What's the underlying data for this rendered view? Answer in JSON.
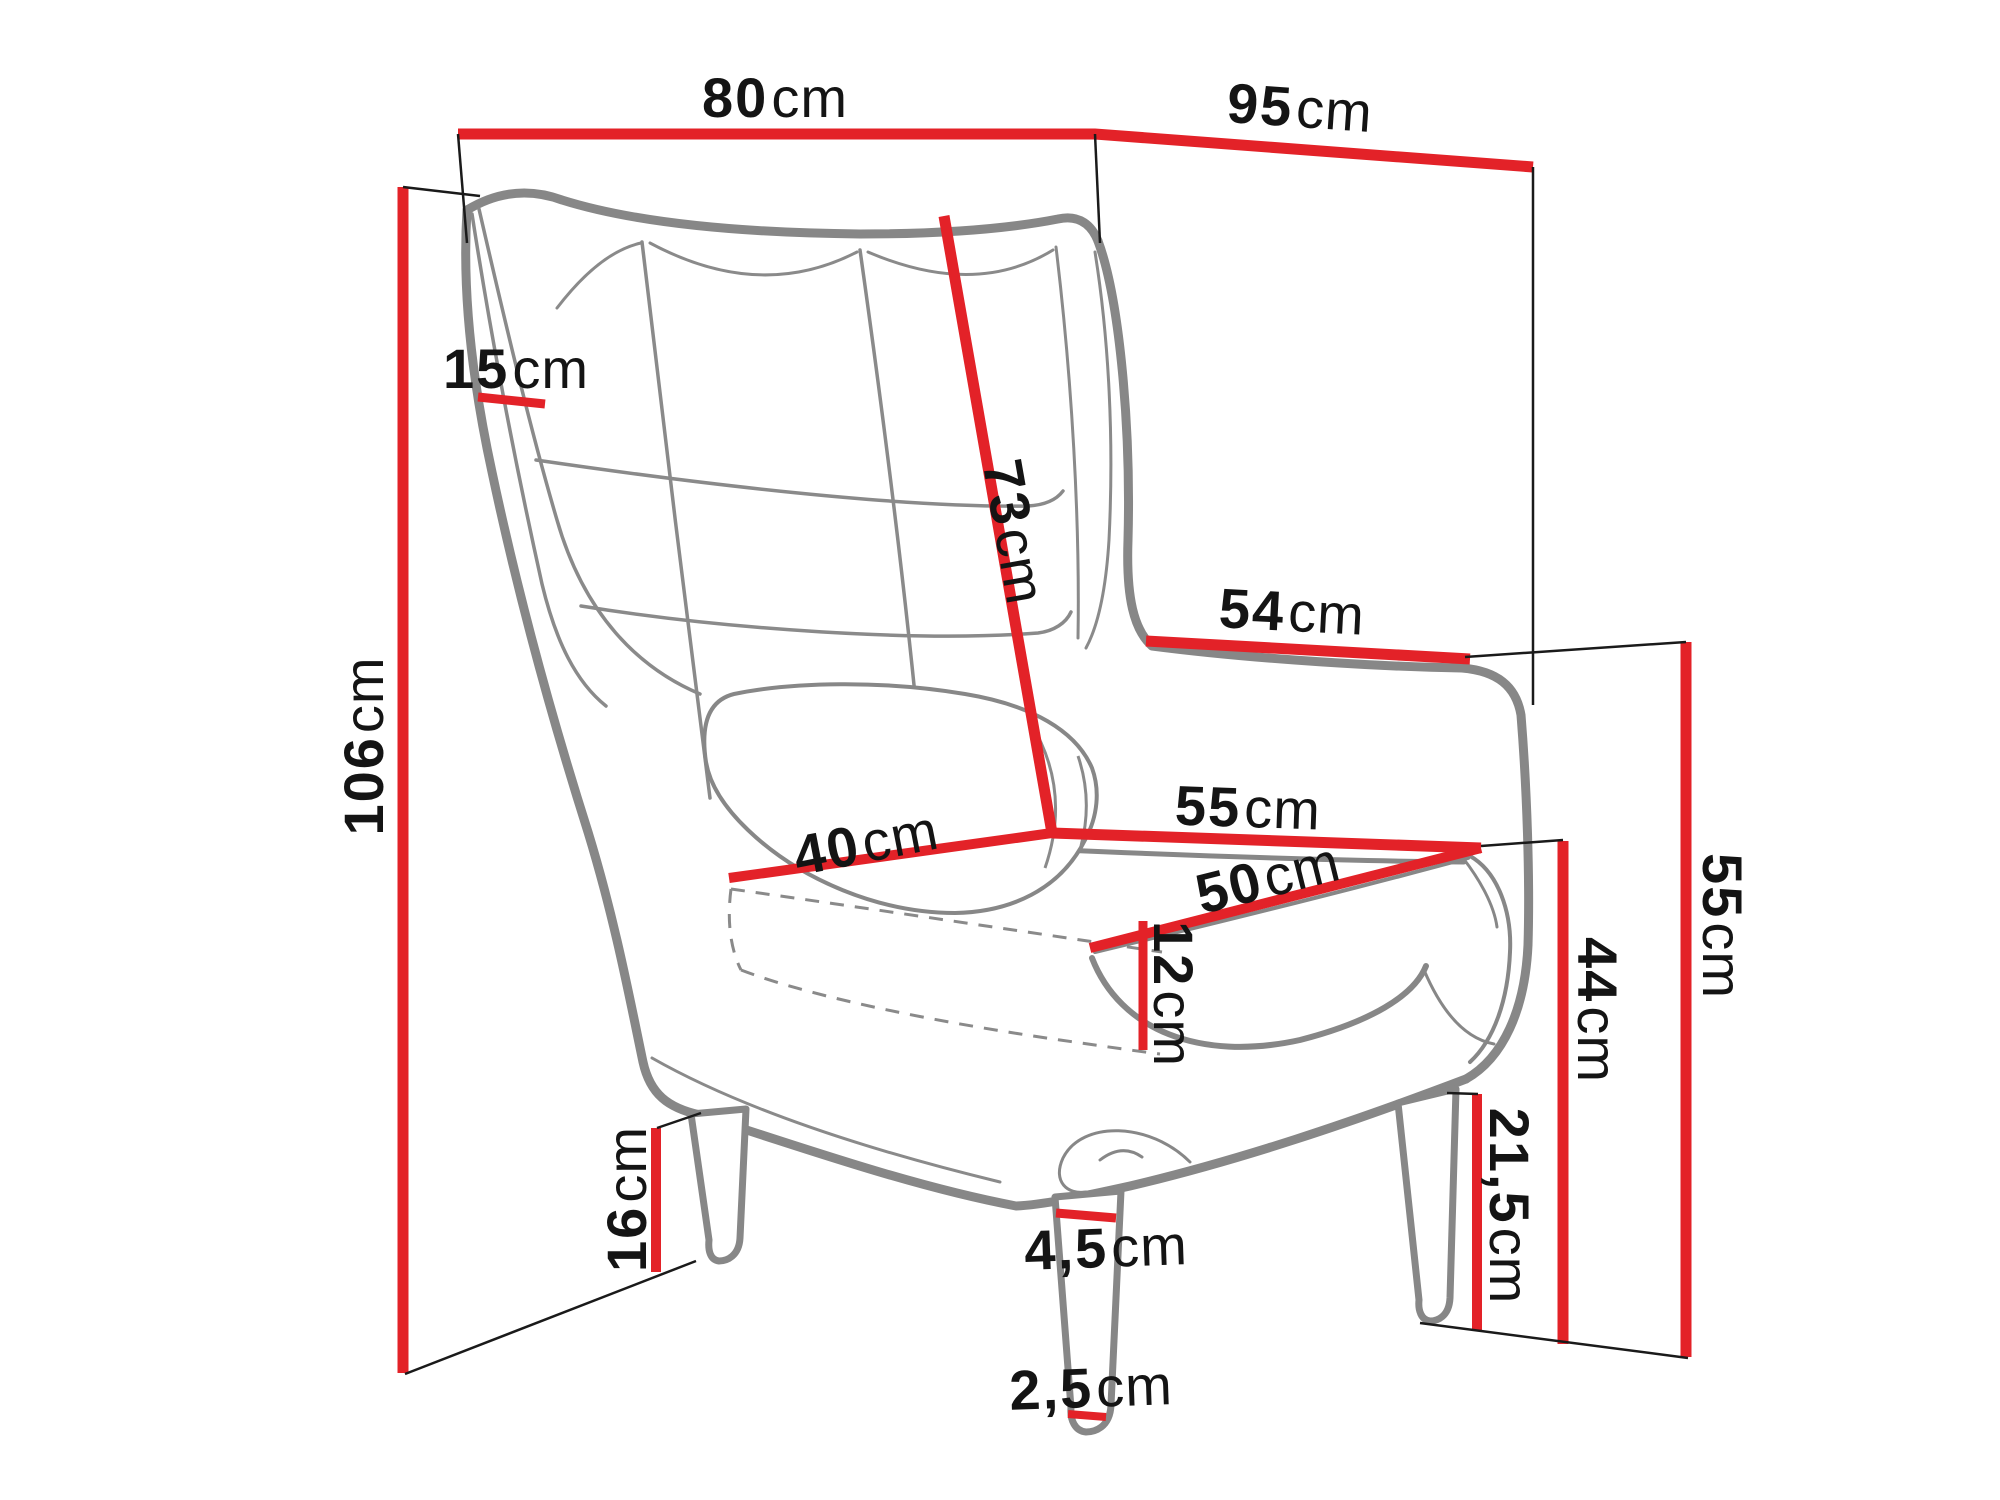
{
  "page": {
    "type": "furniture-dimension-diagram",
    "subject": "wingback armchair line drawing with measurements",
    "background": "#ffffff",
    "unit": "cm"
  },
  "colors": {
    "dimension_line_red": "#e32228",
    "extension_line_black": "#1a1a1a",
    "drawing_outline_gray": "#878787",
    "label_text": "#141414"
  },
  "dimensions": {
    "back_width_top": {
      "value": "80",
      "unit": "cm"
    },
    "total_depth": {
      "value": "95",
      "unit": "cm"
    },
    "total_height": {
      "value": "106",
      "unit": "cm"
    },
    "wing_depth": {
      "value": "15",
      "unit": "cm"
    },
    "backrest_height": {
      "value": "73",
      "unit": "cm"
    },
    "armrest_length": {
      "value": "54",
      "unit": "cm"
    },
    "seat_width_back": {
      "value": "55",
      "unit": "cm"
    },
    "seat_depth": {
      "value": "40",
      "unit": "cm"
    },
    "seat_width_front": {
      "value": "50",
      "unit": "cm"
    },
    "seat_cushion_thickness": {
      "value": "12",
      "unit": "cm"
    },
    "armrest_height": {
      "value": "55",
      "unit": "cm"
    },
    "seat_height": {
      "value": "44",
      "unit": "cm"
    },
    "under_seat_clearance": {
      "value": "21,5",
      "unit": "cm"
    },
    "rear_leg_height": {
      "value": "16",
      "unit": "cm"
    },
    "front_leg_top_width": {
      "value": "4,5",
      "unit": "cm"
    },
    "front_leg_bottom_width": {
      "value": "2,5",
      "unit": "cm"
    }
  }
}
